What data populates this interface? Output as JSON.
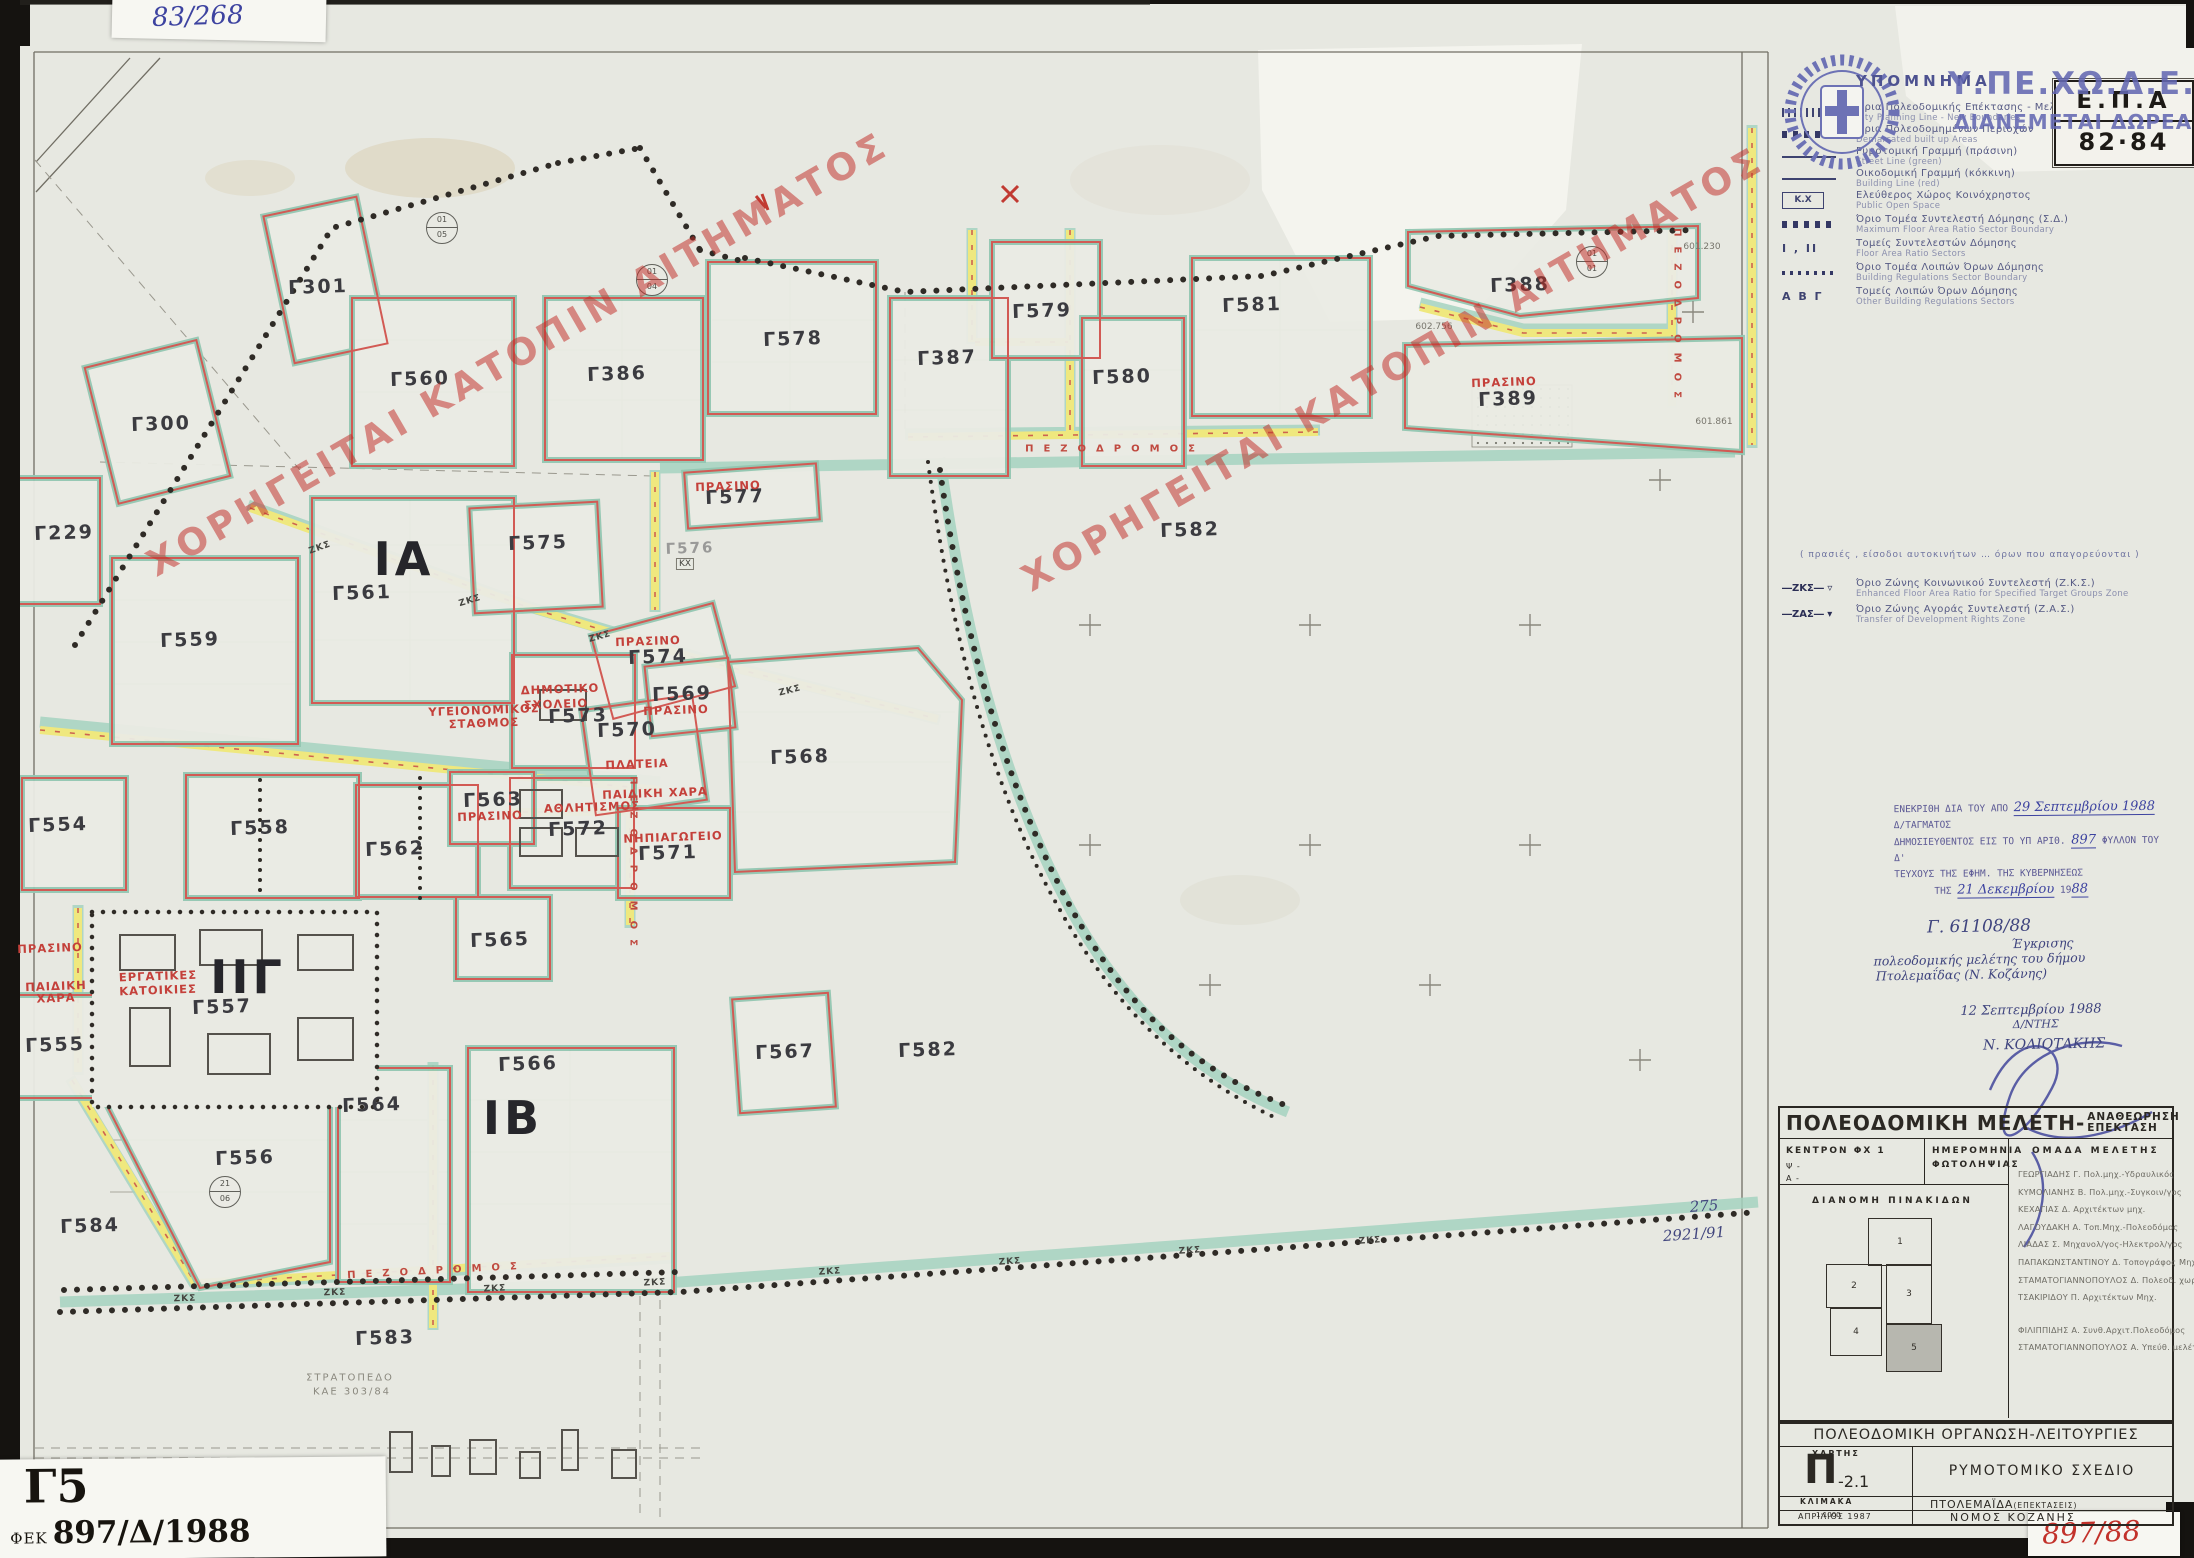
{
  "palette": {
    "paper": "#e7e8e1",
    "red_line": "#d25a54",
    "teal": "#a5d2bf",
    "yellow": "#efe87e",
    "stamp_blue": "#5d63ae",
    "pen_blue": "#3d43a0",
    "red_text": "#c4403a"
  },
  "page": {
    "top_left_code": "83/268",
    "epa_line1": "Ε.Π.Α",
    "epa_line2": "82·84",
    "overprint_line1": "Υ.ΠΕ.ΧΩ.Δ.Ε.",
    "overprint_line2": "ΔΙΑΝΕΜΕΤΑΙ ΔΩΡΕΑΝ"
  },
  "legend": {
    "title": "ΥΠΟΜΝΗΜΑ",
    "items": [
      {
        "sym": "hatch",
        "gr": "Όρια Πολεοδομικής Επέκτασης - Μελέτης",
        "en": "City Planning Line - New Boundaries"
      },
      {
        "sym": "dots-lg",
        "gr": "Όρια Πολεοδομημένων Περιοχών",
        "en": "Demarcated built up Areas"
      },
      {
        "sym": "line-green",
        "gr": "Ρυμοτομική Γραμμή (πράσινη)",
        "en": "Street Line (green)"
      },
      {
        "sym": "line-red",
        "gr": "Οικοδομική Γραμμή (κόκκινη)",
        "en": "Building Line (red)"
      },
      {
        "sym": "box",
        "sym_label": "Κ.Χ",
        "gr": "Ελεύθερος Χώρος Κοινόχρηστος",
        "en": "Public Open Space"
      },
      {
        "sym": "dots-lg",
        "gr": "Όριο Τομέα Συντελεστή Δόμησης (Σ.Δ.)",
        "en": "Maximum Floor Area Ratio Sector Boundary"
      },
      {
        "sym": "text",
        "sym_label": "Ι , ΙΙ",
        "gr": "Τομείς Συντελεστών Δόμησης",
        "en": "Floor Area Ratio Sectors"
      },
      {
        "sym": "dots-sm",
        "gr": "Όριο Τομέα Λοιπών Όρων Δόμησης",
        "en": "Building Regulations Sector Boundary"
      },
      {
        "sym": "text",
        "sym_label": "Α Β Γ",
        "gr": "Τομείς Λοιπών Όρων Δόμησης",
        "en": "Other Building Regulations Sectors"
      }
    ],
    "note": "( πρασιές , είσοδοι αυτοκινήτων … όρων που απαγορεύονται )",
    "zones": [
      {
        "abbr": "ΖΚΣ",
        "gr": "Όριο Ζώνης Κοινωνικού Συντελεστή (Ζ.Κ.Σ.)",
        "en": "Enhanced Floor Area Ratio for Specified Target Groups Zone"
      },
      {
        "abbr": "ΖΑΣ",
        "gr": "Όριο Ζώνης Αγοράς Συντελεστή (Ζ.Α.Σ.)",
        "en": "Transfer of Development Rights Zone"
      }
    ]
  },
  "watermark": {
    "text": "ΧΟΡΗΓΕΙΤΑΙ ΚΑΤΟΠΙΝ ΑΙΤΗΜΑΤΟΣ"
  },
  "stamp": {
    "l1a": "ΕΝΕΚΡΙΘΗ ΔΙΑ ΤΟΥ ΑΠΟ",
    "h1": "29 Σεπτεμβρίου 1988",
    "l1b": "Δ/ΤΑΓΜΑΤΟΣ",
    "l2a": "ΔΗΜΟΣΙΕΥΘΕΝΤΟΣ ΕΙΣ ΤΟ ΥΠ ΑΡΙΘ.",
    "h2": "897",
    "l2b": "ΦΥΛΛΟΝ ΤΟΥ Δ'",
    "l3": "ΤΕΥΧΟΥΣ ΤΗΣ ΕΦΗΜ. ΤΗΣ ΚΥΒΕΡΝΗΣΕΩΣ",
    "l4a": "ΤΗΣ",
    "h3": "21 Δεκεμβρίου",
    "l4b": "19",
    "h4": "88"
  },
  "note": {
    "ref": "Γ. 61108/88",
    "line1": "Έγκρισης",
    "line2": "πολεοδομικής μελέτης του δήμου",
    "line3": "Πτολεμαΐδας (Ν. Κοζάνης)",
    "date": "12 Σεπτεμβρίου 1988",
    "role": "Δ/ΝΤΗΣ",
    "name": "Ν. ΚΟΛΙΟΤΑΚΗΣ"
  },
  "title_block": {
    "title": "ΠΟΛΕΟΔΟΜΙΚΗ ΜΕΛΕΤΗ-",
    "title2a": "ΑΝΑΘΕΩΡΗΣΗ",
    "title2b": "ΕΠΕΚΤΑΣΗ",
    "c1a": "ΚΕΝΤΡΟΝ ΦΧ 1",
    "c1b": "Ψ -",
    "c1c": "Α -",
    "c2a": "ΗΜΕΡΟΜΗΝΙΑ",
    "c2b": "ΦΩΤΟΛΗΨΙΑΣ",
    "c3": "ΟΜΑΔΑ ΜΕΛΕΤΗΣ",
    "team": [
      "ΓΕΩΡΓΙΑΔΗΣ Γ.  Πολ.μηχ.-Υδραυλικός",
      "ΚΥΜΟΛΙΑΝΗΣ Β.  Πολ.μηχ.-Συγκοιν/γος",
      "ΚΕΧΑΓΙΑΣ Δ.  Αρχιτέκτων μηχ.",
      "ΛΑΓΟΥΔΑΚΗ Α.  Τοπ.Μηχ.-Πολεοδόμος",
      "ΛΙΑΔΑΣ Σ.  Μηχανολ/γος-Ηλεκτρολ/γος",
      "ΠΑΠΑΚΩΝΣΤΑΝΤΙΝΟΥ Δ.  Τοπογράφος Μηχ.",
      "ΣΤΑΜΑΤΟΓΙΑΝΝΟΠΟΥΛΟΣ Δ.  Πολεοδ. χωροτ.",
      "ΤΣΑΚΙΡΙΔΟΥ Π.  Αρχιτέκτων Μηχ.",
      "ΦΙΛΙΠΠΙΔΗΣ Α.  Συνθ.Αρχιτ.Πολεοδόμος",
      "ΣΤΑΜΑΤΟΓΙΑΝΝΟΠΟΥΛΟΣ Α.  Υπεύθ. μελέτης"
    ],
    "dist": "ΔΙΑΝΟΜΗ ΠΙΝΑΚΙΔΩΝ",
    "sheets": [
      "1",
      "2",
      "3",
      "4",
      "5"
    ]
  },
  "sheet_block": {
    "title": "ΠΟΛΕΟΔΟΜΙΚΗ ΟΡΓΑΝΩΣΗ-ΛΕΙΤΟΥΡΓΙΕΣ",
    "map_label": "ΧΑΡΤΗΣ",
    "map_letter": "Π",
    "map_num": "-2.1",
    "map_type": "ΡΥΜΟΤΟΜΙΚΟ ΣΧΕΔΙΟ",
    "scale_label": "ΚΛΙΜΑΚΑ",
    "scale": "1:1000",
    "date": "ΑΠΡΙΛΙΟΣ 1987",
    "city": "ΠΤΟΛΕΜΑΪΔΑ",
    "city_suffix": "(ΕΠΕΚΤΑΣΕΙΣ)",
    "prefecture": "ΝΟΜΟΣ ΚΟΖΑΝΗΣ"
  },
  "corner": {
    "sheet": "Γ5",
    "fek_label": "ΦΕΚ",
    "fek_number": "897/Δ/1988",
    "red_code": "897/88"
  },
  "map": {
    "road_label": "ΠΕΖΟΔΡΟΜΟΣ",
    "zks_label": "ΖΚΣ",
    "kx_label": "ΚΧ",
    "camp_line1": "ΣΤΡΑΤΟΠΕΔΟ",
    "camp_line2": "ΚΑΕ 303/84",
    "blocks": [
      {
        "id": "Γ300",
        "x": 161,
        "y": 424
      },
      {
        "id": "Γ301",
        "x": 318,
        "y": 287
      },
      {
        "id": "Γ560",
        "x": 420,
        "y": 379
      },
      {
        "id": "Γ386",
        "x": 617,
        "y": 374
      },
      {
        "id": "Γ578",
        "x": 793,
        "y": 339
      },
      {
        "id": "Γ387",
        "x": 947,
        "y": 358
      },
      {
        "id": "Γ579",
        "x": 1042,
        "y": 311
      },
      {
        "id": "Γ580",
        "x": 1122,
        "y": 377
      },
      {
        "id": "Γ581",
        "x": 1252,
        "y": 305
      },
      {
        "id": "Γ388",
        "x": 1520,
        "y": 285
      },
      {
        "id": "Γ389",
        "x": 1508,
        "y": 399
      },
      {
        "id": "Γ229",
        "x": 64,
        "y": 533
      },
      {
        "id": "Γ559",
        "x": 190,
        "y": 640
      },
      {
        "id": "Γ561",
        "x": 362,
        "y": 593
      },
      {
        "id": "Γ575",
        "x": 538,
        "y": 543
      },
      {
        "id": "Γ576",
        "x": 690,
        "y": 548,
        "faint": true
      },
      {
        "id": "Γ577",
        "x": 735,
        "y": 497
      },
      {
        "id": "Γ574",
        "x": 658,
        "y": 657
      },
      {
        "id": "Γ573",
        "x": 578,
        "y": 716
      },
      {
        "id": "Γ569",
        "x": 682,
        "y": 694
      },
      {
        "id": "Γ570",
        "x": 627,
        "y": 730
      },
      {
        "id": "Γ568",
        "x": 800,
        "y": 757
      },
      {
        "id": "Γ572",
        "x": 578,
        "y": 829
      },
      {
        "id": "Γ571",
        "x": 668,
        "y": 853
      },
      {
        "id": "Γ582",
        "x": 1190,
        "y": 530
      },
      {
        "id": "Γ582",
        "x": 928,
        "y": 1050
      },
      {
        "id": "Γ554",
        "x": 58,
        "y": 825
      },
      {
        "id": "Γ558",
        "x": 260,
        "y": 828
      },
      {
        "id": "Γ562",
        "x": 395,
        "y": 849
      },
      {
        "id": "Γ563",
        "x": 493,
        "y": 800
      },
      {
        "id": "Γ565",
        "x": 500,
        "y": 940
      },
      {
        "id": "Γ557",
        "x": 222,
        "y": 1007
      },
      {
        "id": "Γ555",
        "x": 55,
        "y": 1045
      },
      {
        "id": "Γ556",
        "x": 245,
        "y": 1158
      },
      {
        "id": "Γ564",
        "x": 372,
        "y": 1105
      },
      {
        "id": "Γ566",
        "x": 528,
        "y": 1064
      },
      {
        "id": "Γ567",
        "x": 785,
        "y": 1052
      },
      {
        "id": "Γ584",
        "x": 90,
        "y": 1226
      },
      {
        "id": "Γ583",
        "x": 385,
        "y": 1338
      }
    ],
    "zones": [
      {
        "id": "ΙΑ",
        "x": 404,
        "y": 559
      },
      {
        "id": "ΙΒ",
        "x": 513,
        "y": 1118
      },
      {
        "id": "ΙΙΓ",
        "x": 248,
        "y": 977
      }
    ],
    "uses": [
      {
        "t": "ΠΡΑΣΙΝΟ",
        "x": 648,
        "y": 641
      },
      {
        "t": "ΔΗΜΟΤΙΚΟ",
        "x": 560,
        "y": 689
      },
      {
        "t": "ΣΧΟΛΕΙΟ",
        "x": 556,
        "y": 704
      },
      {
        "t": "ΠΡΑΣΙΝΟ",
        "x": 676,
        "y": 710
      },
      {
        "t": "ΠΛΑΤΕΙΑ",
        "x": 637,
        "y": 764
      },
      {
        "t": "ΠΑΙΔΙΚΗ ΧΑΡΑ",
        "x": 655,
        "y": 793
      },
      {
        "t": "ΑΘΛΗΤΙΣΜΟΣ",
        "x": 592,
        "y": 807
      },
      {
        "t": "ΝΗΠΙΑΓΩΓΕΙΟ",
        "x": 673,
        "y": 837
      },
      {
        "t": "ΠΡΑΣΙΝΟ",
        "x": 728,
        "y": 486
      },
      {
        "t": "ΥΓΕΙΟΝΟΜΙΚΟΣ",
        "x": 484,
        "y": 710
      },
      {
        "t": "ΣΤΑΘΜΟΣ",
        "x": 484,
        "y": 723
      },
      {
        "t": "ΕΡΓΑΤΙΚΕΣ",
        "x": 158,
        "y": 976
      },
      {
        "t": "ΚΑΤΟΙΚΙΕΣ",
        "x": 158,
        "y": 990
      },
      {
        "t": "ΠΡΑΣΙΝΟ",
        "x": 50,
        "y": 948
      },
      {
        "t": "ΠΑΙΔΙΚΗ",
        "x": 56,
        "y": 986
      },
      {
        "t": "ΧΑΡΑ",
        "x": 56,
        "y": 998
      },
      {
        "t": "ΠΡΑΣΙΝΟ",
        "x": 1504,
        "y": 382
      },
      {
        "t": "ΠΡΑΣΙΝΟ",
        "x": 490,
        "y": 816
      }
    ],
    "survey_marks": [
      {
        "t": "601.230",
        "x": 1702,
        "y": 247
      },
      {
        "t": "602.756",
        "x": 1434,
        "y": 327
      },
      {
        "t": "601.861",
        "x": 1714,
        "y": 422
      }
    ],
    "circles": [
      {
        "a": "01",
        "b": "05",
        "x": 442,
        "y": 228
      },
      {
        "a": "01",
        "b": "04",
        "x": 652,
        "y": 280
      },
      {
        "a": "21",
        "b": "06",
        "x": 225,
        "y": 1192
      },
      {
        "a": "01",
        "b": "01",
        "x": 1592,
        "y": 262
      }
    ],
    "annotations": [
      {
        "t": "275",
        "x": 1704,
        "y": 1206
      },
      {
        "t": "2921/91",
        "x": 1694,
        "y": 1234
      }
    ]
  }
}
